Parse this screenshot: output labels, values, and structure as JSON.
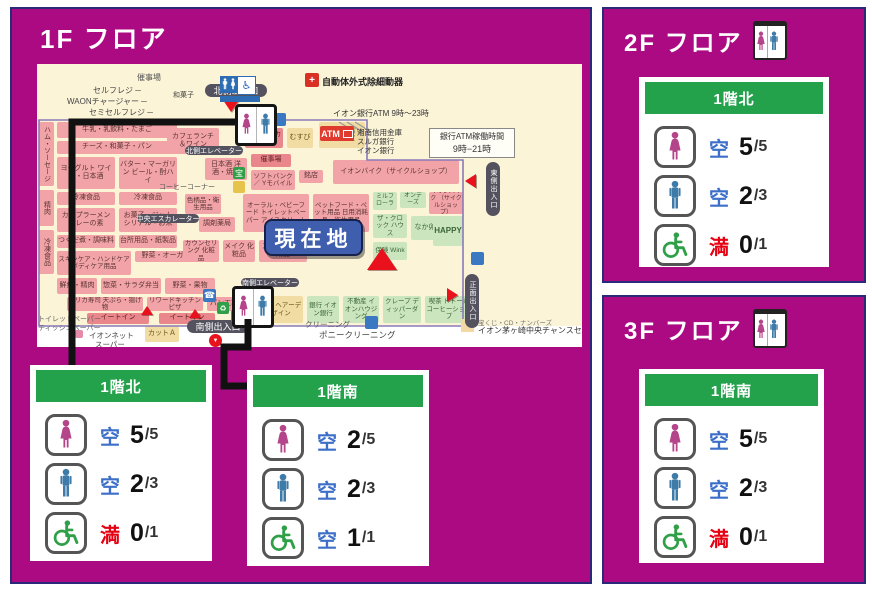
{
  "colors": {
    "magenta": "#AC0A82",
    "panel_border": "#2A2878",
    "header_green": "#23A24B",
    "vacant_blue": "#3D6FC9",
    "full_red": "#E60012",
    "female_pink": "#B5458A",
    "male_blue": "#3E7BA8",
    "wheelchair_green": "#2FA048",
    "map_bg": "#FBF4D7",
    "route_black": "#111111",
    "current_bg": "#3F5EAD",
    "boundary_purple": "#8A7AB8",
    "accent_red": "#E8111C",
    "legend_swatch": "#F2D9A6"
  },
  "floors": [
    {
      "id": "panel-1f",
      "title": "1F フロア",
      "icon": false
    },
    {
      "id": "panel-2f",
      "title": "2F フロア",
      "icon": true
    },
    {
      "id": "panel-3f",
      "title": "3F フロア",
      "icon": true
    }
  ],
  "cards": [
    {
      "slot": "f1-north",
      "header": "1階北",
      "rows": [
        {
          "icon": "female",
          "status": "空",
          "state": "vacant",
          "count": "5",
          "total": "/5"
        },
        {
          "icon": "male",
          "status": "空",
          "state": "vacant",
          "count": "2",
          "total": "/3"
        },
        {
          "icon": "wheelchair",
          "status": "満",
          "state": "full",
          "count": "0",
          "total": "/1"
        }
      ]
    },
    {
      "slot": "f1-south",
      "header": "1階南",
      "rows": [
        {
          "icon": "female",
          "status": "空",
          "state": "vacant",
          "count": "2",
          "total": "/5"
        },
        {
          "icon": "male",
          "status": "空",
          "state": "vacant",
          "count": "2",
          "total": "/3"
        },
        {
          "icon": "wheelchair",
          "status": "空",
          "state": "vacant",
          "count": "1",
          "total": "/1"
        }
      ]
    },
    {
      "slot": "f2",
      "header": "1階北",
      "rows": [
        {
          "icon": "female",
          "status": "空",
          "state": "vacant",
          "count": "5",
          "total": "/5"
        },
        {
          "icon": "male",
          "status": "空",
          "state": "vacant",
          "count": "2",
          "total": "/3"
        },
        {
          "icon": "wheelchair",
          "status": "満",
          "state": "full",
          "count": "0",
          "total": "/1"
        }
      ]
    },
    {
      "slot": "f3",
      "header": "1階南",
      "rows": [
        {
          "icon": "female",
          "status": "空",
          "state": "vacant",
          "count": "5",
          "total": "/5"
        },
        {
          "icon": "male",
          "status": "空",
          "state": "vacant",
          "count": "2",
          "total": "/3"
        },
        {
          "icon": "wheelchair",
          "status": "満",
          "state": "full",
          "count": "0",
          "total": "/1"
        }
      ]
    }
  ],
  "map": {
    "current_location": {
      "t": "現在地",
      "x": 227,
      "y": 155,
      "w": 95,
      "h": 33
    },
    "legend": {
      "x": 424,
      "y": 253,
      "line1": "宝くじ・CD・ナンバーズ",
      "line2": "イオン茅ヶ崎中央チャンスセンター"
    },
    "aed": {
      "x": 268,
      "y": 9,
      "s": 14
    },
    "atm_badge": {
      "x": 283,
      "y": 62,
      "w": 34,
      "h": 15,
      "label": "ATM"
    },
    "atm_box": {
      "x": 392,
      "y": 64,
      "w": 84,
      "h": 28,
      "line1": "銀行ATM稼働時間",
      "line2": "9時−21時"
    },
    "frebox": {
      "x": 183,
      "y": 12,
      "w": 40
    },
    "boundary_path": "M2,56 H330 V96 H426 V262 H2 Z",
    "escalator_path": "M302,58 l16,10 M310,58 l16,10 M318,58 l16,10",
    "routes": [
      {
        "pts": "223,113 60,113 60,358"
      },
      {
        "pts": "236,310 236,338 212,338 212,377 243,377"
      }
    ],
    "toilet_markers": [
      {
        "x": 198,
        "y": 40,
        "s": 36
      },
      {
        "x": 195,
        "y": 222,
        "s": 36
      }
    ],
    "blocks": [
      {
        "t": "",
        "x": 0,
        "y": 262,
        "w": 545,
        "h": 21,
        "c": "white"
      },
      {
        "t": "ハム・ソーセージ",
        "x": 2,
        "y": 58,
        "w": 15,
        "h": 64,
        "c": "pink",
        "v": 1
      },
      {
        "t": "精肉",
        "x": 2,
        "y": 126,
        "w": 15,
        "h": 36,
        "c": "pink",
        "v": 1
      },
      {
        "t": "冷凍食品",
        "x": 2,
        "y": 166,
        "w": 15,
        "h": 44,
        "c": "pink",
        "v": 1
      },
      {
        "t": "牛乳・乳飲料・たまご",
        "x": 20,
        "y": 58,
        "w": 120,
        "h": 16,
        "c": "pink"
      },
      {
        "t": "チーズ・和菓子・パン",
        "x": 20,
        "y": 77,
        "w": 120,
        "h": 13,
        "c": "pink"
      },
      {
        "t": "ヨーグルト ワイン・日本酒",
        "x": 20,
        "y": 93,
        "w": 58,
        "h": 32,
        "c": "pink"
      },
      {
        "t": "バター・マーガリン ビール・酎ハイ",
        "x": 82,
        "y": 93,
        "w": 58,
        "h": 32,
        "c": "pink"
      },
      {
        "t": "冷凍食品",
        "x": 20,
        "y": 128,
        "w": 58,
        "h": 13,
        "c": "pink"
      },
      {
        "t": "冷凍食品",
        "x": 82,
        "y": 128,
        "w": 58,
        "h": 13,
        "c": "pink"
      },
      {
        "t": "カップラーメン カレーの素",
        "x": 20,
        "y": 144,
        "w": 58,
        "h": 24,
        "c": "pink"
      },
      {
        "t": "お菓子・ジャム シリアル・お米",
        "x": 82,
        "y": 144,
        "w": 58,
        "h": 24,
        "c": "pink"
      },
      {
        "t": "つくだ煮・調味料",
        "x": 20,
        "y": 171,
        "w": 58,
        "h": 13,
        "c": "pink"
      },
      {
        "t": "台所用品・紙製品",
        "x": 82,
        "y": 171,
        "w": 58,
        "h": 13,
        "c": "pink"
      },
      {
        "t": "スキンケア・ハンドケア ボディケア用品",
        "x": 20,
        "y": 187,
        "w": 74,
        "h": 24,
        "c": "pink",
        "fs": 6.5
      },
      {
        "t": "野菜・オーガニック",
        "x": 98,
        "y": 187,
        "w": 76,
        "h": 11,
        "c": "pink"
      },
      {
        "t": "鮮魚・精肉",
        "x": 20,
        "y": 214,
        "w": 40,
        "h": 16,
        "c": "pink"
      },
      {
        "t": "惣菜・サラダ弁当",
        "x": 64,
        "y": 214,
        "w": 60,
        "h": 16,
        "c": "pink"
      },
      {
        "t": "野菜・果物",
        "x": 128,
        "y": 214,
        "w": 50,
        "h": 16,
        "c": "pink"
      },
      {
        "t": "デリカ寿司 天ぷら・揚げ物",
        "x": 30,
        "y": 233,
        "w": 76,
        "h": 14,
        "c": "pink",
        "fs": 6.5
      },
      {
        "t": "リワードキッチン ピザ",
        "x": 110,
        "y": 233,
        "w": 56,
        "h": 14,
        "c": "pink",
        "fs": 6.5
      },
      {
        "t": "パン工場",
        "x": 170,
        "y": 233,
        "w": 34,
        "h": 14,
        "c": "pink"
      },
      {
        "t": "イートイン",
        "x": 50,
        "y": 249,
        "w": 62,
        "h": 11,
        "c": "deep"
      },
      {
        "t": "イートイン",
        "x": 122,
        "y": 249,
        "w": 56,
        "h": 11,
        "c": "deep"
      },
      {
        "t": "カフェランチ ＆ワイン",
        "x": 130,
        "y": 64,
        "w": 52,
        "h": 26,
        "c": "pink"
      },
      {
        "t": "サービス カウンター",
        "x": 208,
        "y": 64,
        "w": 38,
        "h": 20,
        "c": "deep",
        "fs": 6.5
      },
      {
        "t": "むすび",
        "x": 250,
        "y": 64,
        "w": 26,
        "h": 20,
        "c": "tan"
      },
      {
        "t": "ハロー！ パソコン教室",
        "x": 282,
        "y": 58,
        "w": 46,
        "h": 26,
        "c": "tan",
        "fs": 6.5
      },
      {
        "t": "日本酒 洋酒・焼酎",
        "x": 168,
        "y": 94,
        "w": 42,
        "h": 22,
        "c": "pink"
      },
      {
        "t": "催事場",
        "x": 214,
        "y": 90,
        "w": 40,
        "h": 13,
        "c": "deep"
      },
      {
        "t": "ソフトバンク／ Yモバイル",
        "x": 214,
        "y": 106,
        "w": 44,
        "h": 20,
        "c": "pink",
        "fs": 6.5
      },
      {
        "t": "銘店",
        "x": 262,
        "y": 106,
        "w": 24,
        "h": 13,
        "c": "pink"
      },
      {
        "t": "イオンバイク（サイクルショップ）",
        "x": 296,
        "y": 96,
        "w": 126,
        "h": 24,
        "c": "pink"
      },
      {
        "t": "色柄品・衛生用品",
        "x": 148,
        "y": 130,
        "w": 36,
        "h": 20,
        "c": "pink",
        "fs": 6.5
      },
      {
        "t": "調剤薬局",
        "x": 162,
        "y": 153,
        "w": 36,
        "h": 15,
        "c": "pink"
      },
      {
        "t": "オーラル・ベビーフード トイレットペーパー アイスクリーム",
        "x": 206,
        "y": 130,
        "w": 66,
        "h": 38,
        "c": "pink",
        "fs": 6.5
      },
      {
        "t": "ペットフード・ペット用品 日用消耗品・衛生用品",
        "x": 276,
        "y": 130,
        "w": 56,
        "h": 38,
        "c": "pink",
        "fs": 6.5
      },
      {
        "t": "ミルフローラ",
        "x": 336,
        "y": 128,
        "w": 24,
        "h": 18,
        "c": "green",
        "fs": 6
      },
      {
        "t": "オンデーズ",
        "x": 363,
        "y": 128,
        "w": 26,
        "h": 16,
        "c": "green",
        "fs": 6
      },
      {
        "t": "イオンバイク （サイクルショップ）",
        "x": 392,
        "y": 128,
        "w": 34,
        "h": 22,
        "c": "pink",
        "fs": 6
      },
      {
        "t": "ザ・クロック ハウス",
        "x": 336,
        "y": 150,
        "w": 34,
        "h": 24,
        "c": "green",
        "fs": 6.5
      },
      {
        "t": "なか卯",
        "x": 374,
        "y": 152,
        "w": 28,
        "h": 24,
        "c": "green"
      },
      {
        "t": "HAPPY",
        "x": 396,
        "y": 152,
        "w": 30,
        "h": 30,
        "c": "green",
        "fs": 8
      },
      {
        "t": "保険 Wink",
        "x": 336,
        "y": 178,
        "w": 34,
        "h": 18,
        "c": "green",
        "fs": 6.5
      },
      {
        "t": "カウンセリング 化粧品",
        "x": 146,
        "y": 176,
        "w": 36,
        "h": 22,
        "c": "pink",
        "fs": 6.5
      },
      {
        "t": "メイク 化粧品",
        "x": 186,
        "y": 176,
        "w": 32,
        "h": 22,
        "c": "pink"
      },
      {
        "t": "スタイリング用品",
        "x": 222,
        "y": 176,
        "w": 48,
        "h": 22,
        "c": "pink"
      },
      {
        "t": "NoB ヘアーデザイン",
        "x": 222,
        "y": 232,
        "w": 44,
        "h": 27,
        "c": "tan",
        "fs": 6.5
      },
      {
        "t": "銀行 イオン銀行",
        "x": 270,
        "y": 232,
        "w": 32,
        "h": 27,
        "c": "green",
        "fs": 6.5
      },
      {
        "t": "不動産 イオンハウジング",
        "x": 306,
        "y": 232,
        "w": 36,
        "h": 27,
        "c": "green",
        "fs": 6.5
      },
      {
        "t": "クレープ ディッパーダン",
        "x": 346,
        "y": 232,
        "w": 38,
        "h": 27,
        "c": "green",
        "fs": 6.5
      },
      {
        "t": "喫茶 ドトールコーヒーショップ",
        "x": 388,
        "y": 232,
        "w": 48,
        "h": 27,
        "c": "green",
        "fs": 6.5
      },
      {
        "t": "カットＡ",
        "x": 108,
        "y": 262,
        "w": 34,
        "h": 16,
        "c": "tan"
      }
    ],
    "texts": [
      {
        "t": "催事場",
        "x": 100,
        "y": 8,
        "fs": 8,
        "c": "#555"
      },
      {
        "t": "セルフレジ ─",
        "x": 56,
        "y": 21,
        "fs": 8,
        "c": "#444"
      },
      {
        "t": "WAONチャージャー ─",
        "x": 30,
        "y": 32,
        "fs": 8,
        "c": "#444"
      },
      {
        "t": "セミセルフレジ ─",
        "x": 52,
        "y": 43,
        "fs": 8,
        "c": "#444"
      },
      {
        "t": "和菓子",
        "x": 136,
        "y": 26,
        "fs": 7,
        "c": "#444"
      },
      {
        "t": "自動体外式除細動器",
        "x": 285,
        "y": 11,
        "fs": 9,
        "c": "#222",
        "b": 1
      },
      {
        "t": "イオン銀行ATM 9時～23時",
        "x": 296,
        "y": 44,
        "fs": 8,
        "c": "#333"
      },
      {
        "t": "湘南信用金庫",
        "x": 320,
        "y": 63,
        "fs": 7.5,
        "c": "#333"
      },
      {
        "t": "スルガ銀行",
        "x": 320,
        "y": 72,
        "fs": 7.5,
        "c": "#333"
      },
      {
        "t": "イオン銀行",
        "x": 320,
        "y": 81,
        "fs": 7.5,
        "c": "#333"
      },
      {
        "t": "コーヒーコーナー",
        "x": 122,
        "y": 118,
        "fs": 7,
        "c": "#555"
      },
      {
        "t": "トイレットペーパー",
        "x": 1,
        "y": 250,
        "fs": 7,
        "c": "#666"
      },
      {
        "t": "ティッシュペーパー",
        "x": 1,
        "y": 259,
        "fs": 7,
        "c": "#666"
      },
      {
        "t": "イオンネット",
        "x": 52,
        "y": 266,
        "fs": 7.5,
        "c": "#444"
      },
      {
        "t": "スーパー",
        "x": 58,
        "y": 275,
        "fs": 7.5,
        "c": "#444"
      },
      {
        "t": "クリーニング",
        "x": 268,
        "y": 255,
        "fs": 7.5,
        "c": "#555"
      },
      {
        "t": "ポニークリーニング",
        "x": 282,
        "y": 265,
        "fs": 8.5,
        "c": "#444"
      }
    ],
    "pills": [
      {
        "t": "北側出入口",
        "x": 168,
        "y": 20,
        "w": 62,
        "h": 13,
        "fs": 9
      },
      {
        "t": "北側エレベーター",
        "x": 148,
        "y": 82,
        "w": 58,
        "h": 9
      },
      {
        "t": "中央エスカレーター",
        "x": 100,
        "y": 150,
        "w": 62,
        "h": 9
      },
      {
        "t": "南側エレベーター",
        "x": 204,
        "y": 214,
        "w": 58,
        "h": 9
      },
      {
        "t": "南側出入口",
        "x": 150,
        "y": 256,
        "w": 62,
        "h": 13,
        "fs": 9
      },
      {
        "t": "東側出入口",
        "x": 449,
        "y": 98,
        "w": 14,
        "h": 54,
        "v": 1
      },
      {
        "t": "正面出入口",
        "x": 428,
        "y": 210,
        "w": 14,
        "h": 54,
        "v": 1
      }
    ],
    "triangles": [
      {
        "d": "down",
        "x": 186,
        "y": 36,
        "s": 16
      },
      {
        "d": "up",
        "x": 330,
        "y": 184,
        "s": 30
      },
      {
        "d": "left",
        "x": 428,
        "y": 110,
        "s": 15
      },
      {
        "d": "right",
        "x": 410,
        "y": 224,
        "s": 15
      },
      {
        "d": "up",
        "x": 104,
        "y": 242,
        "s": 12
      },
      {
        "d": "up",
        "x": 152,
        "y": 245,
        "s": 12
      }
    ],
    "icons": [
      {
        "k": "stripe",
        "x": 236,
        "y": 49,
        "s": 13,
        "name": "escalator-icon"
      },
      {
        "k": "sq",
        "x": 196,
        "y": 103,
        "s": 12,
        "bg": "#2FA048",
        "g": "宝",
        "gfs": 8,
        "name": "lottery-icon"
      },
      {
        "k": "sq",
        "x": 196,
        "y": 117,
        "s": 12,
        "bg": "#E6C34A",
        "g": "",
        "gfs": 8,
        "name": "service-icon"
      },
      {
        "k": "sq",
        "x": 166,
        "y": 225,
        "s": 13,
        "bg": "#3A78C2",
        "g": "☎",
        "gfs": 9,
        "name": "phone-icon"
      },
      {
        "k": "sq",
        "x": 180,
        "y": 238,
        "s": 12,
        "bg": "#2FA048",
        "g": "♻",
        "gfs": 8,
        "name": "recycle-icon"
      },
      {
        "k": "sq",
        "x": 194,
        "y": 246,
        "s": 12,
        "bg": "#2FA048",
        "g": "♻",
        "gfs": 8,
        "name": "recycle-icon"
      },
      {
        "k": "stripe",
        "x": 434,
        "y": 188,
        "s": 13,
        "name": "bicycle-icon"
      },
      {
        "k": "stripe",
        "x": 328,
        "y": 252,
        "s": 13,
        "name": "bicycle-icon"
      },
      {
        "k": "pin",
        "x": 172,
        "y": 270,
        "s": 13,
        "name": "entrance-pin-icon"
      },
      {
        "k": "sq",
        "x": 38,
        "y": 266,
        "s": 8,
        "bg": "#E58BA8",
        "g": "",
        "gfs": 6,
        "name": "net-super-icon"
      }
    ]
  }
}
